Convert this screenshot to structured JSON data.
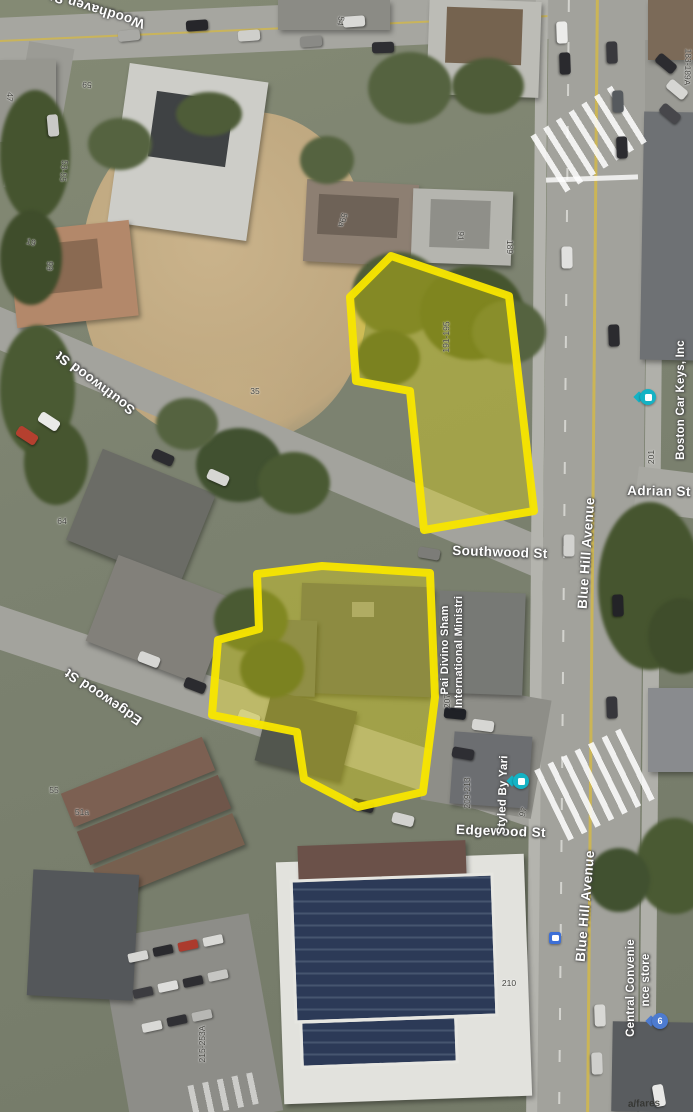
{
  "streets": {
    "woodhaven": "Woodhaven St",
    "southwood": "Southwood St",
    "edgewood": "Edgewood St",
    "blue_hill": "Blue Hill Avenue",
    "adrian": "Adrian St"
  },
  "pois": {
    "boston_car_keys": "Boston Car Keys, Inc",
    "ministry_line1": "Pai Divino Sham",
    "ministry_line2": "International Ministri",
    "styled_by_yari": "Styled By Yari",
    "central_convenience_line1": "Central Convenie",
    "central_convenience_line2": "nce store",
    "blue_pin_glyph": "6",
    "road_text": "a/fares"
  },
  "numbers": [
    "54",
    "47",
    "59",
    "53-55",
    "19",
    "99",
    "59a",
    "91",
    "189",
    "183-189A",
    "191-195",
    "35",
    "64",
    "201",
    "207",
    "209-213",
    "97",
    "55",
    "51a",
    "210",
    "215-253A"
  ],
  "colors": {
    "parcel_outline": "#F7E500",
    "parcel_fill": "rgba(244,232,0,0.33)",
    "teal_pin": "#15B2C4",
    "blue_pin": "#4D7BD0",
    "bus_icon": "#3D6FD6"
  }
}
